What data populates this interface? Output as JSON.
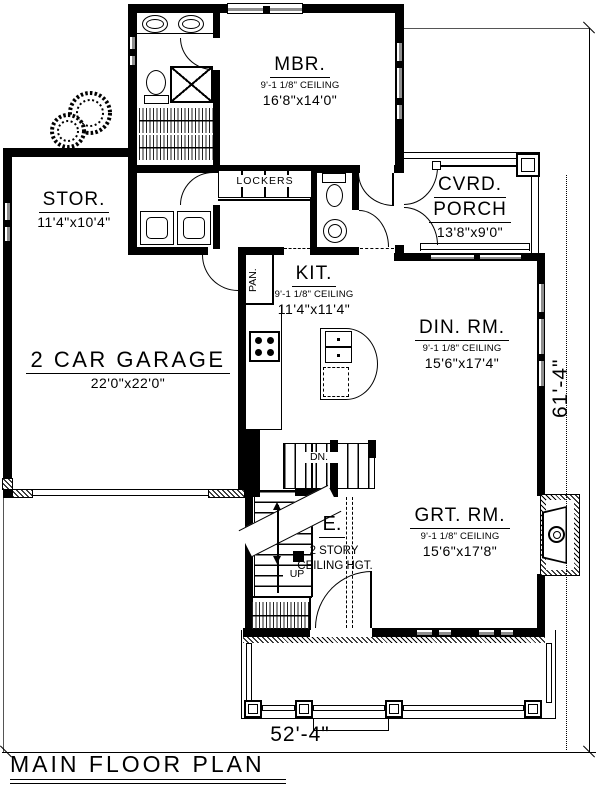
{
  "drawing": {
    "title": "MAIN FLOOR PLAN",
    "dim_width": "52'-4\"",
    "dim_height": "61'-4\""
  },
  "rooms": {
    "mbr": {
      "name": "MBR.",
      "ceiling": "9'-1 1/8\" CEILING",
      "size": "16'8\"x14'0\""
    },
    "stor": {
      "name": "STOR.",
      "size": "11'4\"x10'4\""
    },
    "porch": {
      "name1": "CVRD.",
      "name2": "PORCH",
      "size": "13'8\"x9'0\""
    },
    "kit": {
      "name": "KIT.",
      "ceiling": "9'-1 1/8\" CEILING",
      "size": "11'4\"x11'4\""
    },
    "din": {
      "name": "DIN. RM.",
      "ceiling": "9'-1 1/8\" CEILING",
      "size": "15'6\"x17'4\""
    },
    "garage": {
      "name": "2 CAR GARAGE",
      "size": "22'0\"x22'0\""
    },
    "grt": {
      "name": "GRT. RM.",
      "ceiling": "9'-1 1/8\" CEILING",
      "size": "15'6\"x17'8\""
    },
    "entry": {
      "name": "E.",
      "note1": "2 STORY",
      "note2": "CEILING HGT."
    }
  },
  "labels": {
    "lockers": "LOCKERS",
    "pantry": "PAN.",
    "down": "DN.",
    "up": "UP"
  },
  "colors": {
    "wall": "#000000",
    "window_gray": "#8e8e8e",
    "background": "#ffffff"
  }
}
